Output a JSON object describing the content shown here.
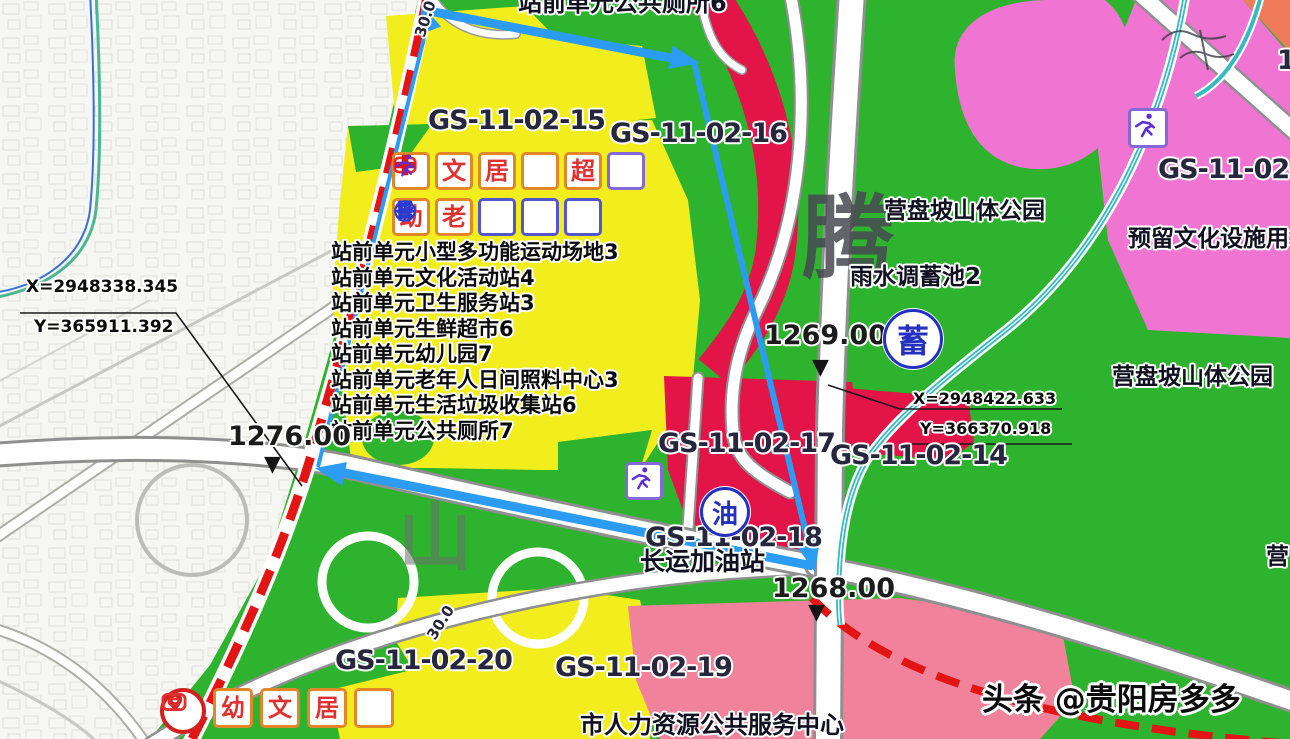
{
  "top_label": "站前单元公共厕所6",
  "parcel_labels": {
    "p15": "GS-11-02-15",
    "p16": "GS-11-02-16",
    "p17": "GS-11-02-17",
    "p14": "GS-11-02-14",
    "p18": "GS-11-02-18",
    "p19": "GS-11-02-19",
    "p20": "GS-11-02-20",
    "p_right_partial": "GS-11-02-",
    "p_top_right_partial": "1"
  },
  "facilities": [
    "站前单元小型多功能运动场地3",
    "站前单元文化活动站4",
    "站前单元卫生服务站3",
    "站前单元生鲜超市6",
    "站前单元幼儿园7",
    "站前单元老年人日间照料中心3",
    "站前单元生活垃圾收集站6",
    "站前单元公共厕所7"
  ],
  "places": {
    "hill_park": "营盘坡山体公园",
    "hill_park_right": "营盘坡山体公园",
    "hill_park_partial": "营",
    "reserved_culture": "预留文化设施用地",
    "rain_pool": "雨水调蓄池2",
    "gas_station": "长运加油站",
    "hr_center": "市人力资源公共服务中心"
  },
  "elevations": {
    "e1276": "1276.00",
    "e1269": "1269.00",
    "e1268": "1268.00",
    "marker_glyph": "▼"
  },
  "coords": {
    "left_x": "X=2948338.345",
    "left_y": "Y=365911.392",
    "right_x": "X=2948422.633",
    "right_y": "Y=366370.918"
  },
  "road_widths": {
    "w1": "30.0",
    "w2": "30.0"
  },
  "badges": {
    "reservoir": "蓄",
    "oil": "油"
  },
  "icons": {
    "culture": "文",
    "residence": "居",
    "supermarket": "超",
    "kindergarten": "幼",
    "elderly": "老"
  },
  "watermarks": {
    "big_char": "腾",
    "hill_char": "山",
    "credit": "头条 @贵阳房多多"
  },
  "colors": {
    "green": "#2db32d",
    "yellow": "#f2ee1e",
    "crimson": "#e21448",
    "pink": "#f075d2",
    "rose": "#f0839b",
    "orange": "#ef7b5a",
    "arrow_blue": "#2b9cf2",
    "rail_red": "#e21414",
    "stream_teal": "#35bac2",
    "road_white": "#ffffff"
  }
}
